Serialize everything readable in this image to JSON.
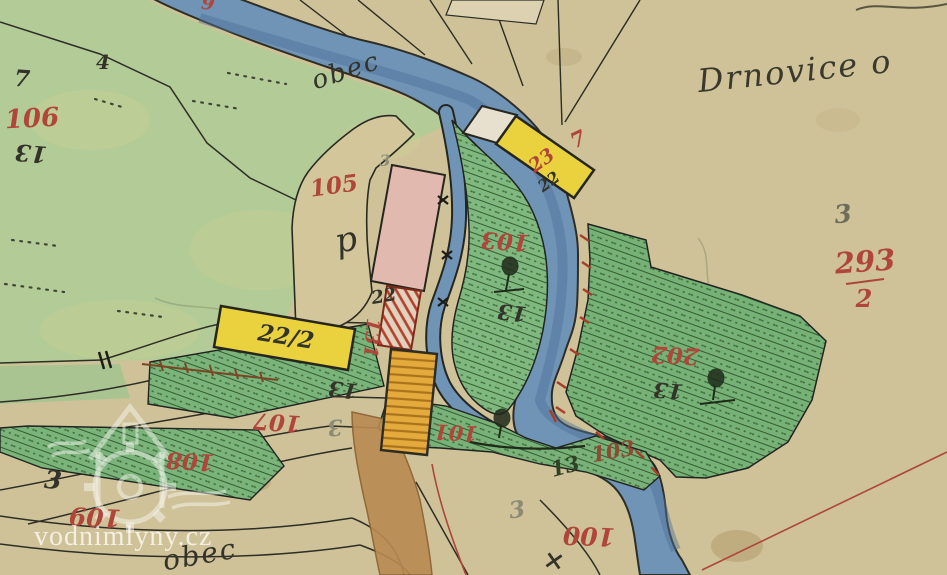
{
  "map_title": "Drnovice o",
  "watermark": {
    "text": "vodnimlyny.cz"
  },
  "colors": {
    "paper": "#cfc298",
    "meadow": "#b3cb97",
    "parcel_green": "#7bb47b",
    "river": "#6f94b6",
    "river_deep": "#4d7298",
    "building_yellow": "#ead23e",
    "building_orange": "#e5aa3c",
    "building_pink": "#e2b9ae",
    "building_red_hatch": "#b33f2b",
    "red_ink": "#b0453a",
    "black_ink": "#33332a",
    "path_brown": "#b98a52"
  },
  "labels": [
    {
      "id": "drnovice",
      "text": "Drnovice o",
      "x": 795,
      "y": 71,
      "rot": -6,
      "size": 32,
      "color": "#3a3a2c",
      "cursive": true
    },
    {
      "id": "obec-top",
      "text": "obec",
      "x": 346,
      "y": 71,
      "rot": -18,
      "size": 26,
      "color": "#33332a",
      "cursive": true
    },
    {
      "id": "obec-bottom",
      "text": "obec",
      "x": 200,
      "y": 555,
      "rot": -10,
      "size": 28,
      "color": "#33332a",
      "cursive": true
    },
    {
      "id": "p-mark",
      "text": "p",
      "x": 347,
      "y": 240,
      "rot": -12,
      "size": 34,
      "color": "#33332a",
      "cursive": true
    },
    {
      "id": "n106",
      "text": "106",
      "x": 32,
      "y": 119,
      "rot": -3,
      "size": 26,
      "color": "#b0453a"
    },
    {
      "id": "n13-a",
      "text": "13",
      "x": 31,
      "y": 153,
      "rot": 185,
      "size": 23,
      "color": "#33332a"
    },
    {
      "id": "n7-a",
      "text": "7",
      "x": 22,
      "y": 79,
      "rot": 4,
      "size": 23,
      "color": "#33332a"
    },
    {
      "id": "n4",
      "text": "4",
      "x": 103,
      "y": 62,
      "rot": 0,
      "size": 20,
      "color": "#33332a"
    },
    {
      "id": "n105",
      "text": "105",
      "x": 334,
      "y": 186,
      "rot": -8,
      "size": 23,
      "color": "#b0453a"
    },
    {
      "id": "n3-e",
      "text": "3",
      "x": 385,
      "y": 161,
      "rot": 0,
      "size": 16,
      "color": "#8e8e7a"
    },
    {
      "id": "n22-a",
      "text": "22",
      "x": 384,
      "y": 297,
      "rot": -10,
      "size": 18,
      "color": "#33332a"
    },
    {
      "id": "n131",
      "text": "131",
      "x": 371,
      "y": 338,
      "rot": 95,
      "size": 19,
      "color": "#b0453a"
    },
    {
      "id": "n22-2",
      "text": "22/2",
      "x": 286,
      "y": 337,
      "rot": 9,
      "size": 23,
      "color": "#33332a"
    },
    {
      "id": "n13-b",
      "text": "13",
      "x": 343,
      "y": 390,
      "rot": 187,
      "size": 21,
      "color": "#33332a"
    },
    {
      "id": "n107",
      "text": "107",
      "x": 277,
      "y": 422,
      "rot": 184,
      "size": 23,
      "color": "#b0453a"
    },
    {
      "id": "n3-a",
      "text": "3",
      "x": 335,
      "y": 427,
      "rot": 175,
      "size": 22,
      "color": "#8b8b76"
    },
    {
      "id": "n103-a",
      "text": "103",
      "x": 505,
      "y": 241,
      "rot": 184,
      "size": 23,
      "color": "#b0453a"
    },
    {
      "id": "n13-c",
      "text": "13",
      "x": 512,
      "y": 313,
      "rot": 186,
      "size": 21,
      "color": "#33332a"
    },
    {
      "id": "n23",
      "text": "23",
      "x": 542,
      "y": 161,
      "rot": -36,
      "size": 19,
      "color": "#b0453a"
    },
    {
      "id": "n7-b",
      "text": "7",
      "x": 578,
      "y": 139,
      "rot": -25,
      "size": 21,
      "color": "#b0453a"
    },
    {
      "id": "n22-b",
      "text": "22",
      "x": 549,
      "y": 182,
      "rot": -36,
      "size": 16,
      "color": "#33332a"
    },
    {
      "id": "n202",
      "text": "202",
      "x": 675,
      "y": 355,
      "rot": 183,
      "size": 23,
      "color": "#b0453a"
    },
    {
      "id": "n13-d",
      "text": "13",
      "x": 668,
      "y": 391,
      "rot": 185,
      "size": 21,
      "color": "#33332a"
    },
    {
      "id": "n3-b",
      "text": "3",
      "x": 843,
      "y": 214,
      "rot": -6,
      "size": 25,
      "color": "#6d6d5a"
    },
    {
      "id": "n293",
      "text": "293",
      "x": 865,
      "y": 262,
      "rot": -4,
      "size": 29,
      "color": "#b0453a"
    },
    {
      "id": "n293-den",
      "text": "2",
      "x": 864,
      "y": 299,
      "rot": 0,
      "size": 24,
      "color": "#b0453a"
    },
    {
      "id": "n101",
      "text": "101",
      "x": 456,
      "y": 433,
      "rot": 183,
      "size": 21,
      "color": "#b0453a"
    },
    {
      "id": "n13-e",
      "text": "13",
      "x": 565,
      "y": 466,
      "rot": -15,
      "size": 21,
      "color": "#2f4226"
    },
    {
      "id": "n103-b",
      "text": "103",
      "x": 613,
      "y": 451,
      "rot": -10,
      "size": 21,
      "color": "#8f4a33"
    },
    {
      "id": "n100",
      "text": "100",
      "x": 589,
      "y": 536,
      "rot": 182,
      "size": 25,
      "color": "#b0453a"
    },
    {
      "id": "n3-c",
      "text": "3",
      "x": 517,
      "y": 510,
      "rot": -8,
      "size": 23,
      "color": "#8b8b76"
    },
    {
      "id": "n108",
      "text": "108",
      "x": 190,
      "y": 461,
      "rot": 183,
      "size": 23,
      "color": "#b0453a"
    },
    {
      "id": "n3-d",
      "text": "3",
      "x": 53,
      "y": 480,
      "rot": 5,
      "size": 25,
      "color": "#33332a"
    },
    {
      "id": "n109",
      "text": "109",
      "x": 95,
      "y": 517,
      "rot": 183,
      "size": 25,
      "color": "#b0453a"
    },
    {
      "id": "n9-top",
      "text": "9",
      "x": 208,
      "y": 4,
      "rot": 8,
      "size": 19,
      "color": "#b0453a"
    },
    {
      "id": "x-mark",
      "text": "×",
      "x": 554,
      "y": 561,
      "rot": 10,
      "size": 26,
      "color": "#33332a"
    }
  ]
}
